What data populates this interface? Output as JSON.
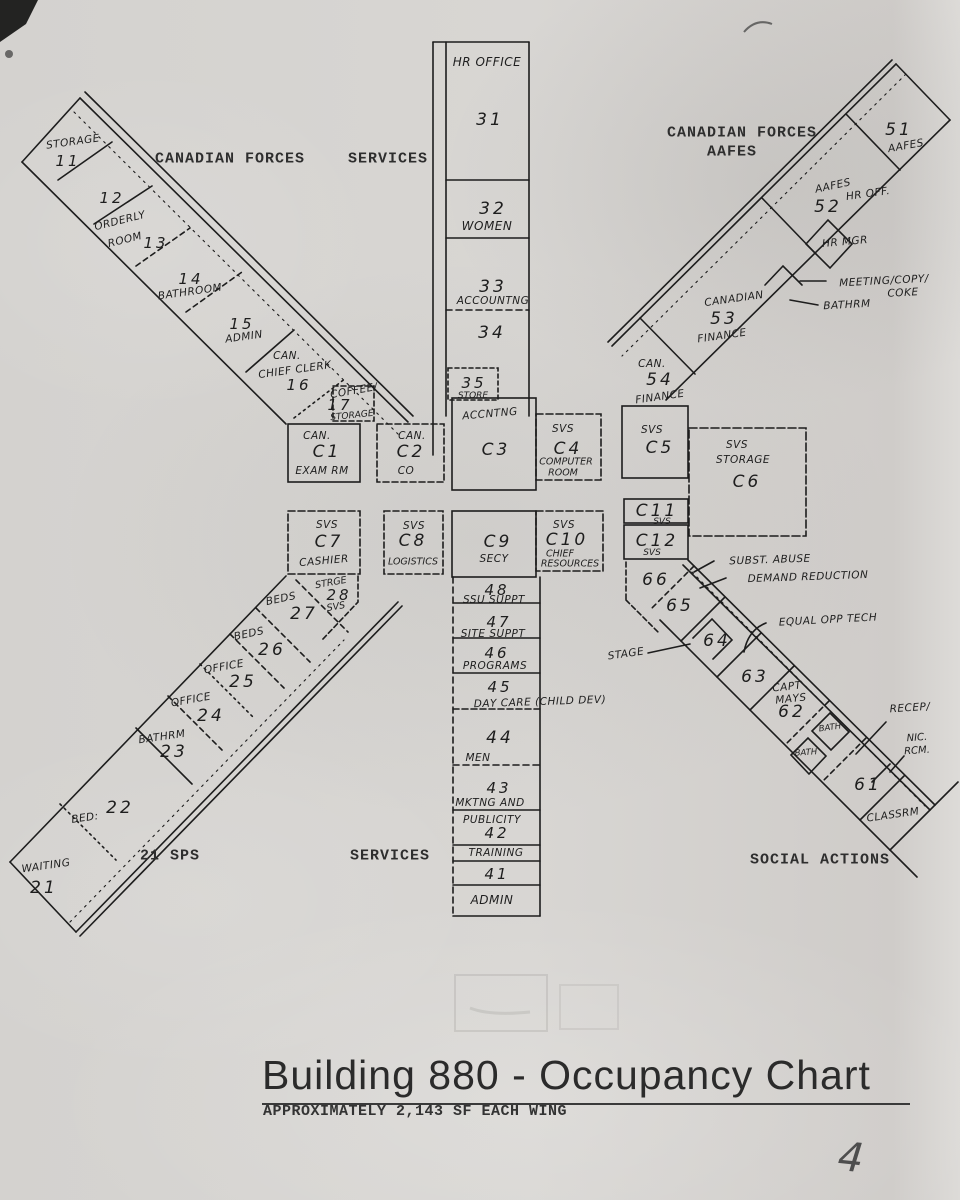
{
  "document": {
    "title": "Building 880 - Occupancy Chart",
    "subtitle": "APPROXIMATELY 2,143 SF EACH WING",
    "page_number": "4"
  },
  "section_labels": {
    "northwest": "CANADIAN FORCES",
    "north": "SERVICES",
    "northeast_line1": "CANADIAN FORCES",
    "northeast_line2": "AAFES",
    "southwest": "21 SPS",
    "south": "SERVICES",
    "southeast": "SOCIAL ACTIONS"
  },
  "northwest_wing": {
    "r11_name": "STORAGE",
    "r11_num": "11",
    "r12_num": "12",
    "r13_name1": "ORDERLY",
    "r13_name2": "ROOM",
    "r13_num": "13",
    "r14_num": "14",
    "r14_name": "BATHROOM",
    "r15_num": "15",
    "r15_name": "ADMIN",
    "r16_name1": "CAN.",
    "r16_name2": "CHIEF CLERK",
    "r16_num": "16",
    "r17_name1": "COFFEE/",
    "r17_num": "17",
    "r17_name2": "STORAGE"
  },
  "north_wing": {
    "header": "HR OFFICE",
    "r31_num": "31",
    "r32_num": "32",
    "r32_name": "WOMEN",
    "r33_num": "33",
    "r33_name": "ACCOUNTNG",
    "r34_num": "34",
    "r35_num": "35",
    "r35_name": "STORE",
    "c3_header": "ACCNTNG"
  },
  "northeast_wing": {
    "r51_num": "51",
    "r51_name": "AAFES",
    "r52_name1": "AAFES",
    "r52_num": "52",
    "r52_name2": "HR OFF.",
    "hr_mgr": "HR MGR",
    "callout_meeting1": "MEETING/COPY/",
    "callout_meeting2": "COKE",
    "callout_bathrm": "BATHRM",
    "r53_name1": "CANADIAN",
    "r53_num": "53",
    "r53_name2": "FINANCE",
    "r54_name1": "CAN.",
    "r54_num": "54",
    "r54_name2": "FINANCE"
  },
  "center_core": {
    "c1": {
      "l1": "CAN.",
      "num": "C1",
      "l2": "EXAM RM"
    },
    "c2": {
      "l1": "CAN.",
      "num": "C2",
      "l2": "CO"
    },
    "c3": {
      "num": "C3"
    },
    "c4": {
      "l1": "SVS",
      "num": "C4",
      "l2": "COMPUTER",
      "l3": "ROOM"
    },
    "c5": {
      "l1": "SVS",
      "num": "C5"
    },
    "c6": {
      "l1": "SVS",
      "l2": "STORAGE",
      "num": "C6"
    },
    "c7": {
      "l1": "SVS",
      "num": "C7",
      "l2": "CASHIER"
    },
    "c8": {
      "l1": "SVS",
      "num": "C8",
      "l2": "LOGISTICS"
    },
    "c9": {
      "num": "C9",
      "l2": "SECY"
    },
    "c10": {
      "l1": "SVS",
      "num": "C10",
      "l2": "CHIEF",
      "l3": "RESOURCES"
    },
    "c11": {
      "num": "C11",
      "l2": "SVS"
    },
    "c12": {
      "num": "C12",
      "l2": "SVS"
    }
  },
  "southwest_wing": {
    "r28_name1": "STRGE",
    "r28_num": "28",
    "r28_name2": "SVS",
    "r27_name": "BEDS",
    "r27_num": "27",
    "r26_name": "BEDS",
    "r26_num": "26",
    "r25_name": "OFFICE",
    "r25_num": "25",
    "r24_name": "OFFICE",
    "r24_num": "24",
    "r23_name": "BATHRM",
    "r23_num": "23",
    "r22_num": "22",
    "r22_name": "BED:",
    "r21_name": "WAITING",
    "r21_num": "21"
  },
  "south_wing": {
    "r48_num": "48",
    "r48_name": "SSU SUPPT",
    "r47_num": "47",
    "r47_name": "SITE SUPPT",
    "r46_num": "46",
    "r46_name": "PROGRAMS",
    "r45_num": "45",
    "r45_name": "DAY CARE (CHILD DEV)",
    "r44_num": "44",
    "r44_name": "MEN",
    "r43_num": "43",
    "r43_name1": "MKTNG AND",
    "r43_name2": "PUBLICITY",
    "r42_num": "42",
    "r42_name": "TRAINING",
    "r41_num": "41",
    "r41_name": "ADMIN"
  },
  "southeast_wing": {
    "r66_num": "66",
    "r65_num": "65",
    "r64_num": "64",
    "callout_stage": "STAGE",
    "callout_subst1": "SUBST. ABUSE",
    "callout_subst2": "DEMAND REDUCTION",
    "callout_equal": "EQUAL OPP TECH",
    "r63_num": "63",
    "r62_name1": "CAPT",
    "r62_name2": "MAYS",
    "r62_num": "62",
    "bath_upper": "BATH",
    "bath_lower": "BATH",
    "callout_recep": "RECEP/",
    "callout_nic1": "NIC.",
    "callout_nic2": "RCM.",
    "r61_num": "61",
    "classrm": "CLASSRM"
  }
}
